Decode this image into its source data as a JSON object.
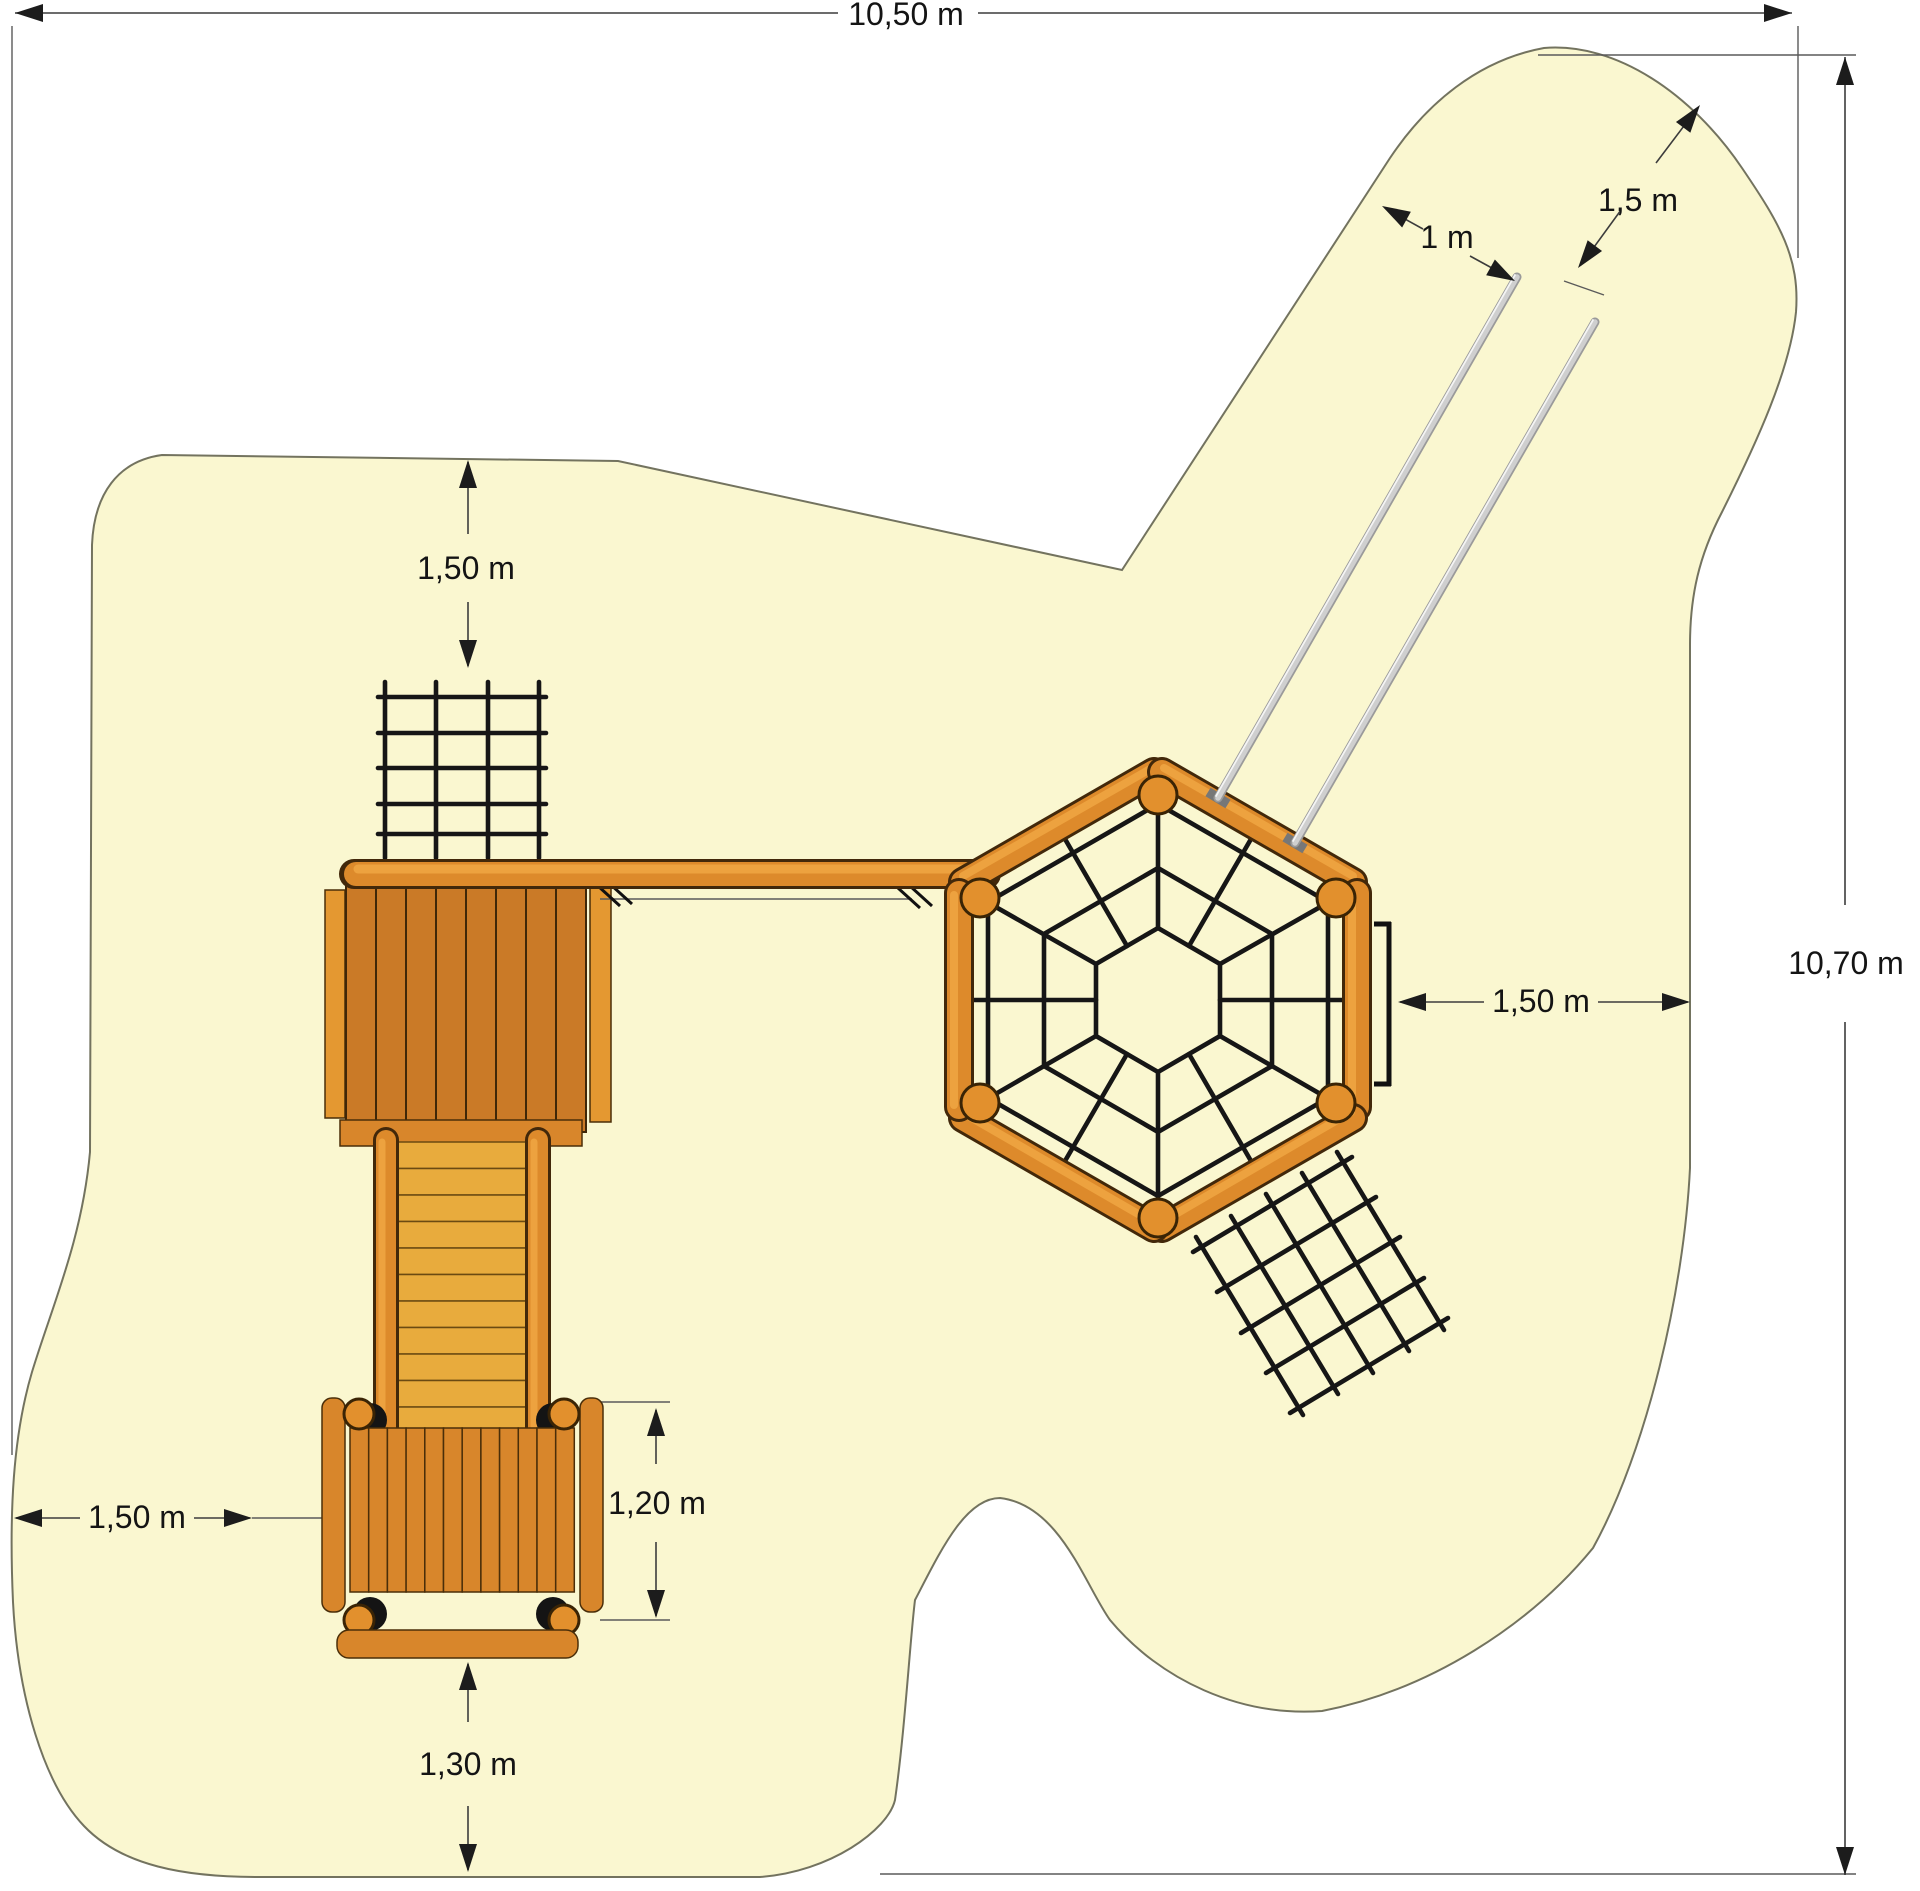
{
  "drawing": {
    "title": "playground-equipment-top-view-plan",
    "dimensions": {
      "total_width": {
        "label": "10,50 m"
      },
      "total_height": {
        "label": "10,70 m"
      },
      "slide_exit_clearance": {
        "label": "1,5 m"
      },
      "slide_width": {
        "label": "1 m"
      },
      "net_top_clearance": {
        "label": "1,50 m"
      },
      "hexagon_right_clearance": {
        "label": "1,50 m"
      },
      "platform_left_clearance": {
        "label": "1,50 m"
      },
      "platform_width": {
        "label": "1,20 m"
      },
      "platform_bottom_clearance": {
        "label": "1,30 m"
      }
    },
    "colors": {
      "safety_zone_fill": "#faf7d0",
      "safety_zone_outline": "#73735f",
      "wood_base": "#dd8a2b",
      "wood_plank": "#ca7a27",
      "wood_step": "#e8ab3d",
      "rope_black": "#161616",
      "slide_rail_gray": "#c9c9c9",
      "dimension_ink": "#141414"
    },
    "components": [
      "safety-zone-area",
      "climbing-net-top",
      "large-tower-roof",
      "bridge-log",
      "staircase",
      "small-platform",
      "hexagon-climbing-frame",
      "spider-web-net",
      "slide-rails",
      "diagonal-climbing-net"
    ]
  }
}
